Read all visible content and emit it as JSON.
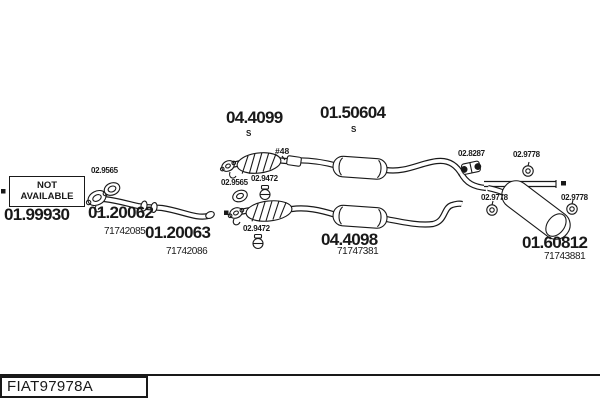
{
  "diagram": {
    "not_available": {
      "line1": "NOT",
      "line2": "AVAILABLE"
    },
    "parts": {
      "front_pipe_na": {
        "number": "01.99930"
      },
      "front_pipe_a": {
        "number": "01.20062",
        "ref": "71742085"
      },
      "front_pipe_b": {
        "number": "01.20063",
        "ref": "71742086"
      },
      "cat_converter": {
        "number": "04.4099",
        "suffix": "S"
      },
      "mid_silencer": {
        "number": "01.50604",
        "suffix": "S"
      },
      "mid_section": {
        "number": "04.4098",
        "ref": "71747381"
      },
      "rear_silencer": {
        "number": "01.60812",
        "ref": "71743881"
      }
    },
    "fittings": {
      "gasket": {
        "code": "02.9565"
      },
      "clamp": {
        "code": "02.9472"
      },
      "coupling": {
        "code": "02.8287"
      },
      "hanger": {
        "code": "02.9778"
      }
    },
    "annotations": {
      "pipe_marker": "#48"
    }
  },
  "footer": {
    "drawing_code": "FIAT97978A"
  },
  "colors": {
    "ink": "#191919",
    "background": "#ffffff"
  }
}
